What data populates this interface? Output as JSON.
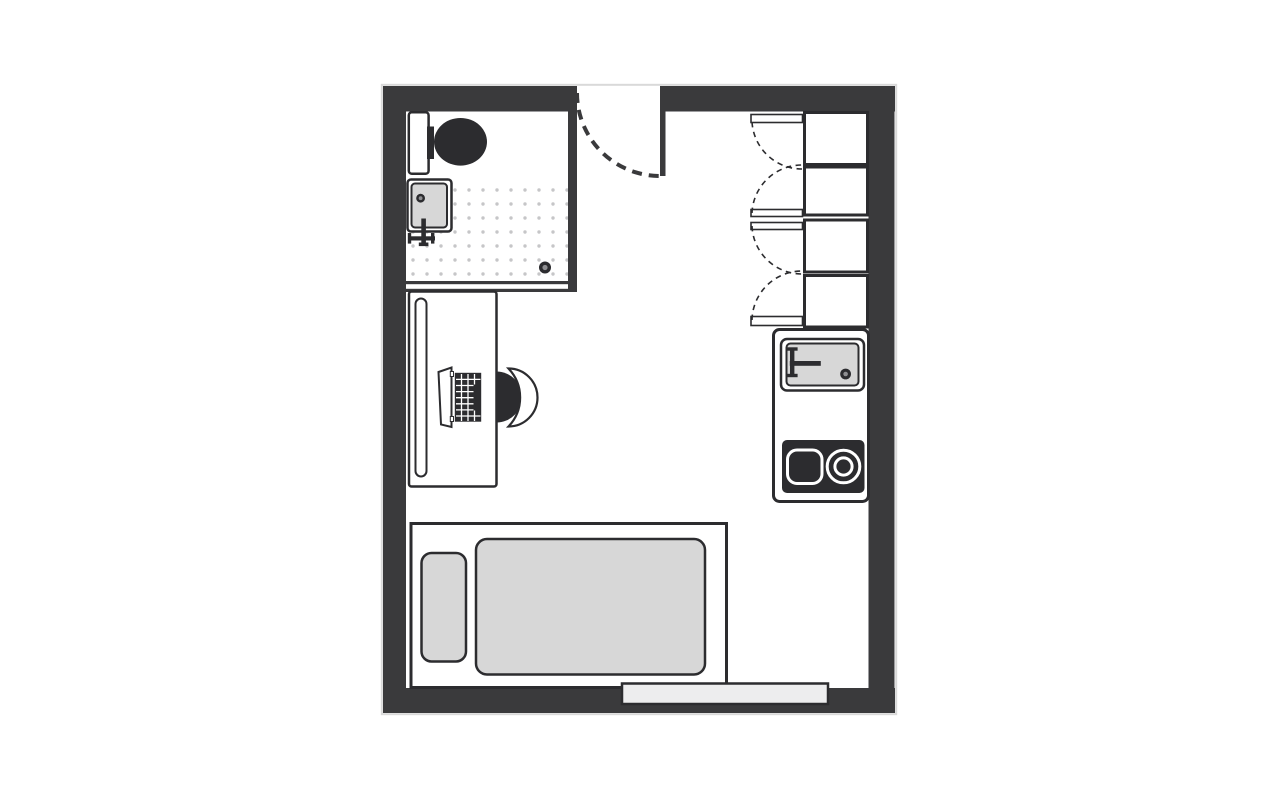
{
  "meta": {
    "title": "Studio apartment floor plan"
  },
  "colors": {
    "page": "#ffffff",
    "wall": "#3a3a3c",
    "outline": "#2c2c2f",
    "fill": "#ffffff",
    "soft": "#d7d7d7",
    "window": "#ededee",
    "dot": "#c6c6c8",
    "drain": "#8f8f92",
    "shadow": "#d9d9d9",
    "ring": "#ffffff"
  },
  "fixtures": {
    "bathroom": [
      "toilet",
      "bathroom-sink",
      "shower-floor",
      "shower-drain"
    ],
    "entry": [
      "entrance-door-swing"
    ],
    "storage": [
      "wardrobe-section x4",
      "wardrobe-door x4"
    ],
    "workspace": [
      "desk",
      "desk-shelf",
      "laptop",
      "desk-chair"
    ],
    "kitchen": [
      "kitchen-counter",
      "kitchen-sink",
      "cooktop-square-burner",
      "cooktop-round-burner"
    ],
    "sleeping": [
      "bed-frame",
      "pillow",
      "duvet"
    ],
    "openings": [
      "window"
    ]
  }
}
